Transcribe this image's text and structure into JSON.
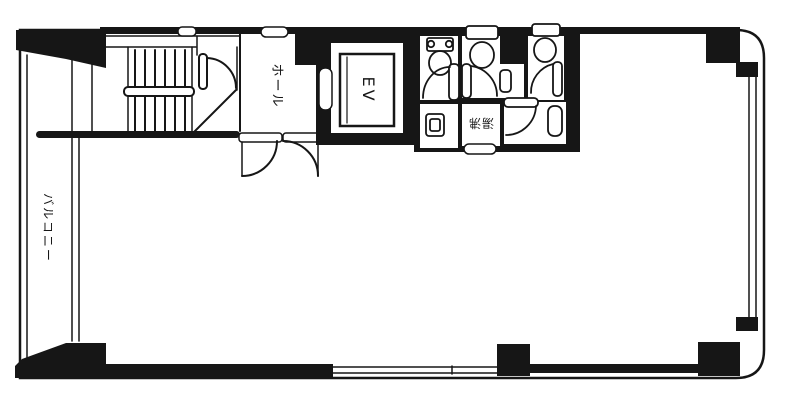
{
  "floor_plan": {
    "labels": {
      "hall": "ホール",
      "elevator": "EV",
      "water_heating": "湯沸",
      "balcony": "バルコニー"
    },
    "colors": {
      "ink": "#161616",
      "paper": "#ffffff"
    }
  }
}
